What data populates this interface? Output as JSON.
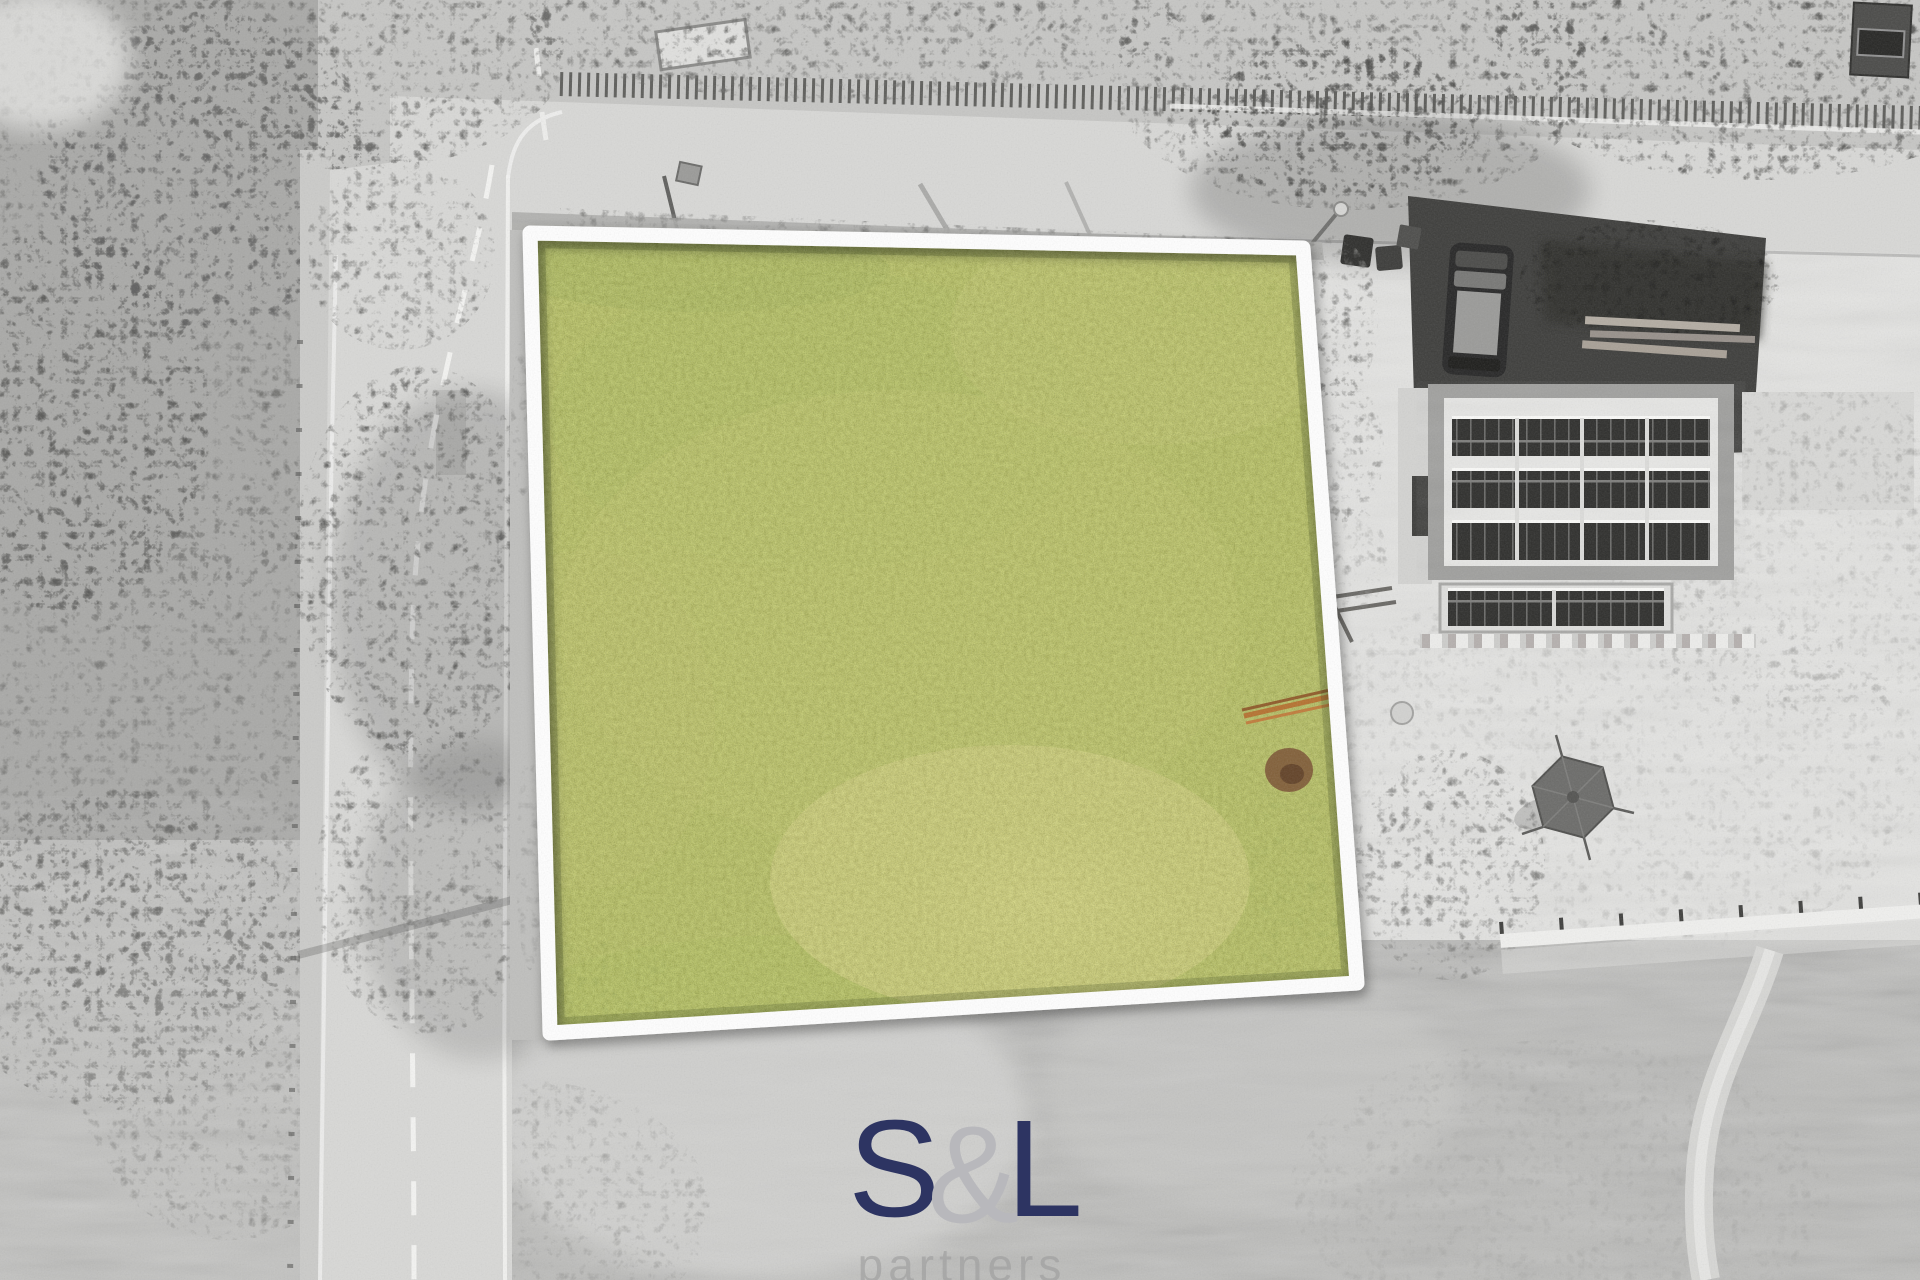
{
  "watermark": {
    "letter_s": "S",
    "ampersand": "&",
    "letter_l": "L",
    "subtitle": "partners",
    "letters_color": "#2d3462",
    "ampersand_color": "#b8b8bc",
    "subtitle_color": "#9c9c9c"
  },
  "scene": {
    "plot": {
      "border_color": "#ffffff",
      "grass_base_color": "#9ba04e",
      "grass_dark_color": "#5b7531",
      "grass_light_color": "#b2ad61",
      "dry_patch_color": "#d4c287",
      "pipes_color": "#b5712f",
      "dirt_color": "#7c5534"
    },
    "roads": {
      "asphalt_color": "#d8d8d6",
      "marking_color": "#f5f5f3",
      "shoulder_color": "#cbcbc9"
    },
    "house": {
      "roof_color": "#e8e8e6",
      "eaves_color": "#9e9e9c",
      "wing_color": "#d3d3d1",
      "solar_panel_color": "#2e2e2c",
      "window_color": "#3c3c3a"
    },
    "driveway_color": "#3d3d3b",
    "van_color": "#262626",
    "van_roof_color": "#9a9a98",
    "vegetation_dark_color": "#6b6b69",
    "meadow_color": "#bcbcba",
    "yard_color": "#e4e4e2",
    "gazebo_color": "#6b6b69"
  }
}
